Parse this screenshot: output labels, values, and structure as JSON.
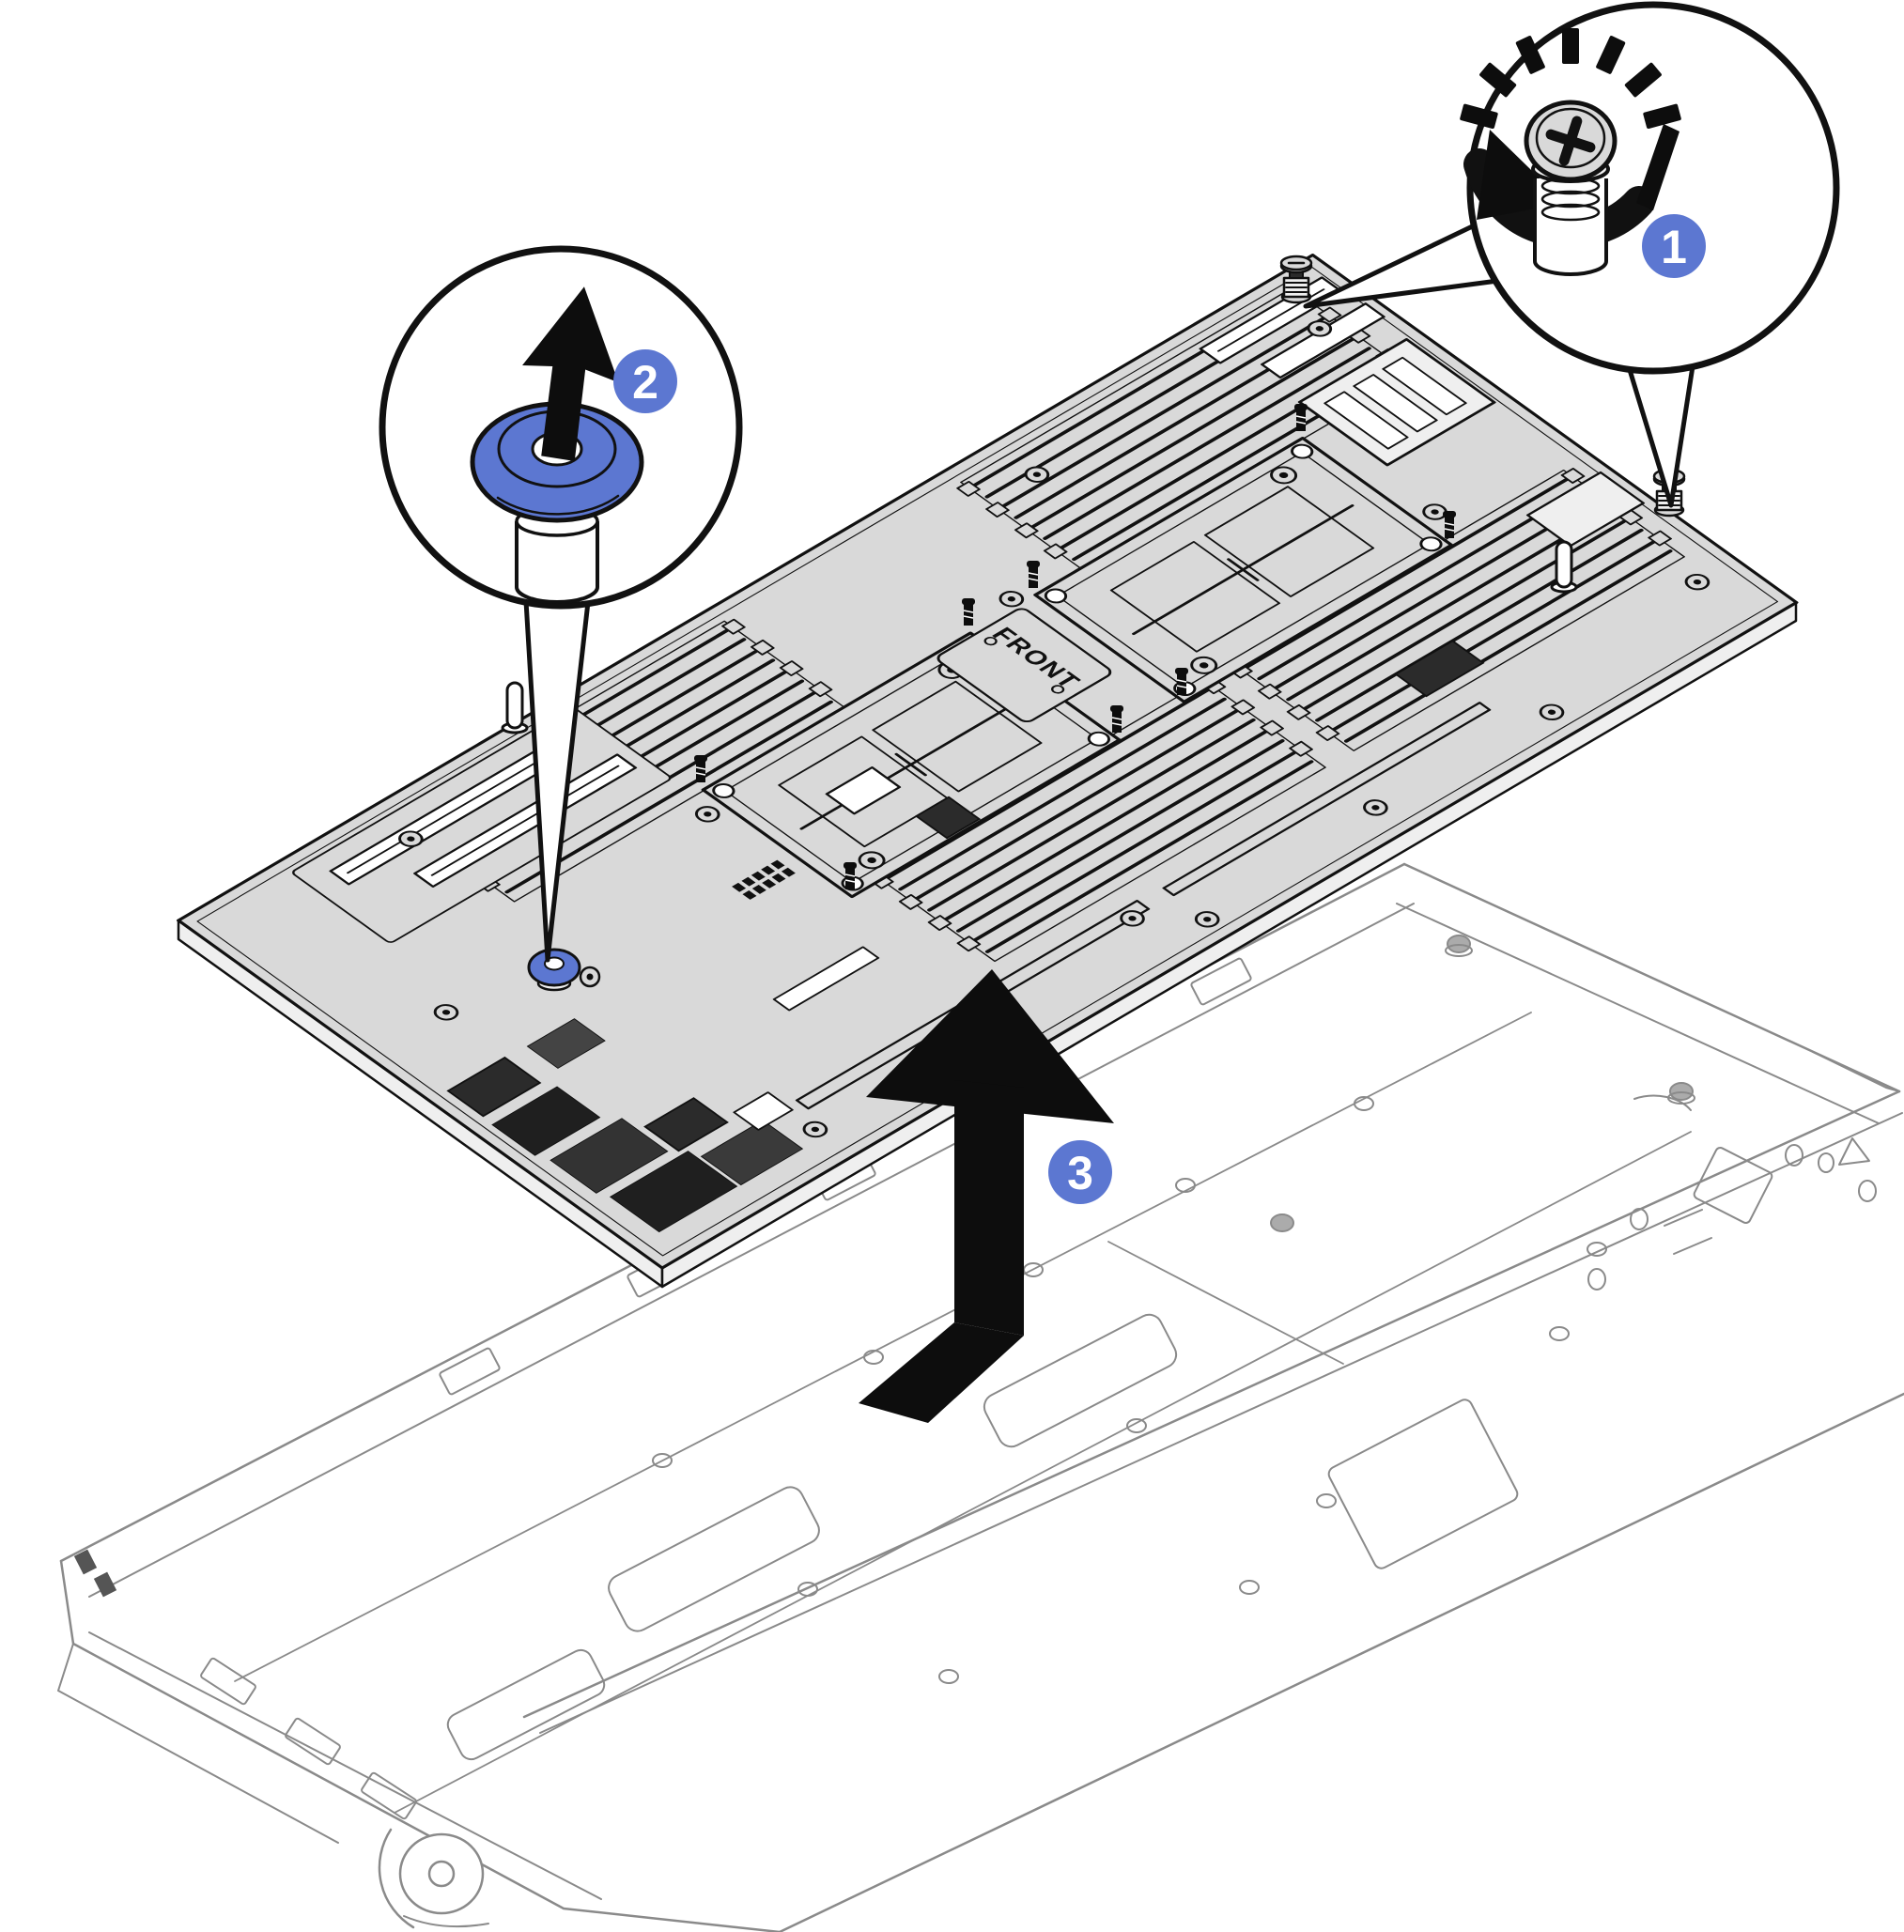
{
  "figure": {
    "kind": "hardware-removal-illustration",
    "subject": "system-board-removal-from-tray",
    "board_label": "FRONT",
    "steps": [
      {
        "number": "1",
        "icon": "rotate-loosen-arrow-icon",
        "target": "captive-thumbscrew"
      },
      {
        "number": "2",
        "icon": "pull-up-arrow-icon",
        "target": "lift-plunger"
      },
      {
        "number": "3",
        "icon": "lift-remove-arrow-icon",
        "target": "system-board"
      }
    ],
    "colors": {
      "accent_blue": "#5c77d1",
      "board_fill": "#d9d9d9",
      "line": "#111111",
      "chassis_line": "#8a8a8a",
      "arrow_black": "#0d0d0d",
      "badge_text": "#ffffff"
    }
  }
}
